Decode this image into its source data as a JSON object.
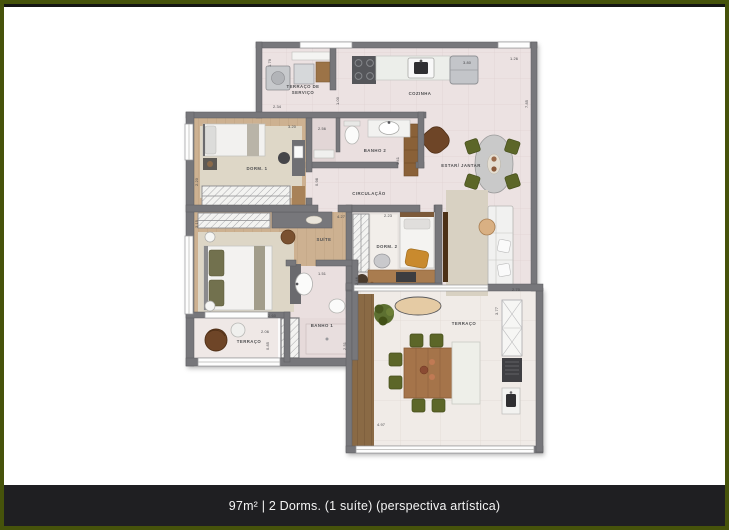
{
  "meta": {
    "type": "apartment-floor-plan"
  },
  "caption": {
    "text": "97m² | 2 Dorms. (1 suíte) (perspectiva artística)"
  },
  "colors": {
    "frame_border": "#46530b",
    "caption_bar": "#1f1f22",
    "caption_text": "#f4f4f4",
    "wall": "#77777b",
    "floor_tile": "#ece2e2",
    "floor_wood": "#cdb191",
    "deck_wood": "#8a6a45",
    "accent_olive": "#5c6628",
    "accent_brown": "#6e4527"
  },
  "rooms": {
    "servico": {
      "line1": "TERRAÇO DE",
      "line2": "SERVIÇO"
    },
    "cozinha": {
      "label": "COZINHA"
    },
    "estar": {
      "label": "ESTAR/ JANTAR"
    },
    "dorm1": {
      "label": "DORM. 1"
    },
    "banho2": {
      "label": "BANHO 2"
    },
    "circulacao": {
      "label": "CIRCULAÇÃO"
    },
    "suite": {
      "label": "SUÍTE"
    },
    "dorm2": {
      "label": "DORM. 2"
    },
    "banho1": {
      "label": "BANHO 1"
    },
    "terraco_pequeno": {
      "label": "TERRAÇO"
    },
    "terraco": {
      "label": "TERRAÇO"
    }
  },
  "dims": {
    "d1_79": "1.79",
    "d2_34": "2.34",
    "d1_00": "1.00",
    "d3_80": "3.80",
    "d1_26": "1.26",
    "d7_85": "7.85",
    "d3_20": "3.20",
    "d2_56": "2.56",
    "d2_20": "2.20",
    "d1_41": "1.41",
    "d0_98": "0.98",
    "d4_27": "4.27",
    "d2_23": "2.23",
    "d3_15": "3.15",
    "d2_46": "2.46",
    "d2_60": "2.60",
    "d1_51": "1.51",
    "d2_51": "2.51",
    "d2_06": "2.06",
    "d0_85": "0.85",
    "d2_70": "2.70",
    "d3_77": "3.77",
    "d4_97": "4.97"
  }
}
